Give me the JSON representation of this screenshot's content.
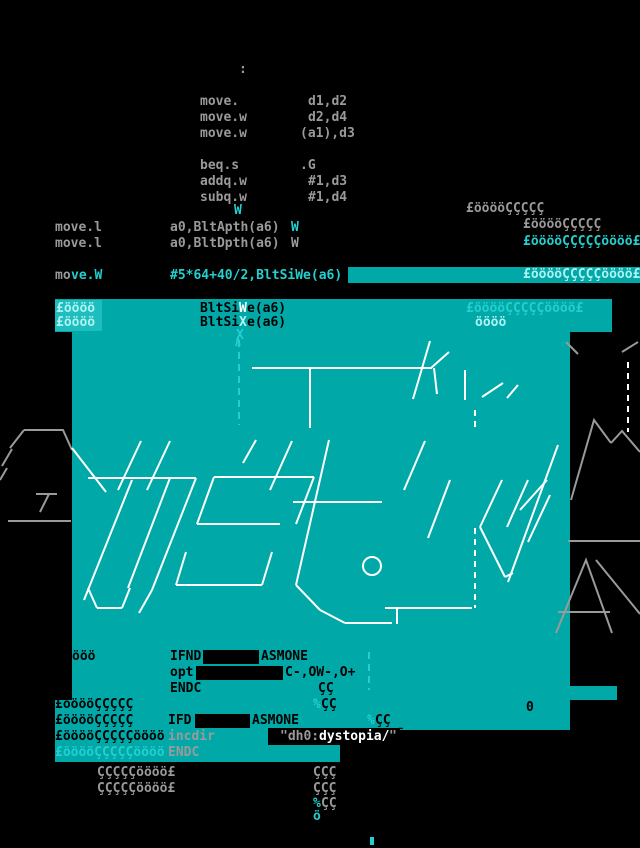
{
  "palette": {
    "black": "#000000",
    "teal": "#00A8A8",
    "pale_box": "#1FBEBE",
    "cyan": "#24CFCF",
    "bright": "#AFF2F2",
    "gray": "#9A9A9A",
    "white": "#FFFFFF"
  },
  "screen": {
    "width": 640,
    "height": 848,
    "background": "#000000"
  },
  "boxes": [
    {
      "n": "move-w-highlight-bar",
      "x": 348,
      "y": 267,
      "w": 292,
      "h": 16,
      "c": "teal"
    },
    {
      "n": "bltsize-band",
      "x": 55,
      "y": 299,
      "w": 557,
      "h": 33,
      "c": "teal"
    },
    {
      "n": "pale-highlight-box",
      "x": 55,
      "y": 300,
      "w": 47,
      "h": 31,
      "c": "pale_box"
    },
    {
      "n": "main-teal-block",
      "x": 72,
      "y": 332,
      "w": 498,
      "h": 323,
      "c": "teal"
    },
    {
      "n": "lower-teal-band",
      "x": 55,
      "y": 655,
      "w": 515,
      "h": 75,
      "c": "teal"
    },
    {
      "n": "teal-notch-right",
      "x": 570,
      "y": 686,
      "w": 47,
      "h": 14,
      "c": "teal"
    },
    {
      "n": "bottom-teal-strip",
      "x": 55,
      "y": 730,
      "w": 285,
      "h": 32,
      "c": "teal"
    },
    {
      "n": "left-black-box",
      "x": 55,
      "y": 648,
      "w": 17,
      "h": 52,
      "c": "black"
    },
    {
      "n": "ifnd-redacted-box",
      "x": 203,
      "y": 650,
      "w": 56,
      "h": 14,
      "c": "black"
    },
    {
      "n": "opt-redacted-box",
      "x": 196,
      "y": 666,
      "w": 87,
      "h": 14,
      "c": "black"
    },
    {
      "n": "ifd-redacted-box",
      "x": 195,
      "y": 714,
      "w": 55,
      "h": 14,
      "c": "black"
    },
    {
      "n": "dystopia-black-box",
      "x": 268,
      "y": 728,
      "w": 132,
      "h": 17,
      "c": "black"
    },
    {
      "n": "bottom-cyan-tick",
      "x": 370,
      "y": 837,
      "w": 4,
      "h": 8,
      "c": "cyan"
    }
  ],
  "texts": [
    {
      "n": "label-colon",
      "x": 239,
      "y": 63,
      "c": "gray",
      "t": ":"
    },
    {
      "n": "asm-op",
      "x": 200,
      "y": 95,
      "c": "gray",
      "t": "move."
    },
    {
      "n": "asm-arg",
      "x": 308,
      "y": 95,
      "c": "gray",
      "t": "d1,d2"
    },
    {
      "n": "asm-op",
      "x": 200,
      "y": 111,
      "c": "gray",
      "t": "move.w"
    },
    {
      "n": "asm-arg",
      "x": 308,
      "y": 111,
      "c": "gray",
      "t": "d2,d4"
    },
    {
      "n": "asm-op",
      "x": 200,
      "y": 127,
      "c": "gray",
      "t": "move.w"
    },
    {
      "n": "asm-arg",
      "x": 300,
      "y": 127,
      "c": "gray",
      "t": "(a1),d3"
    },
    {
      "n": "asm-op",
      "x": 200,
      "y": 159,
      "c": "gray",
      "t": "beq.s"
    },
    {
      "n": "asm-arg",
      "x": 300,
      "y": 159,
      "c": "gray",
      "t": ".G"
    },
    {
      "n": "asm-op",
      "x": 200,
      "y": 175,
      "c": "gray",
      "t": "addq.w"
    },
    {
      "n": "asm-arg",
      "x": 308,
      "y": 175,
      "c": "gray",
      "t": "#1,d3"
    },
    {
      "n": "asm-op",
      "x": 200,
      "y": 191,
      "c": "gray",
      "t": "subq.w"
    },
    {
      "n": "asm-arg",
      "x": 308,
      "y": 191,
      "c": "gray",
      "t": "#1,d4"
    },
    {
      "n": "stray-w",
      "x": 234,
      "y": 204,
      "c": "cyan",
      "t": "W"
    },
    {
      "n": "asm-op",
      "x": 55,
      "y": 221,
      "c": "gray",
      "t": "move.l"
    },
    {
      "n": "asm-arg",
      "x": 170,
      "y": 221,
      "c": "gray",
      "t": "a0,BltApth(a6)"
    },
    {
      "n": "stray-w",
      "x": 291,
      "y": 221,
      "c": "cyan",
      "t": "W"
    },
    {
      "n": "asm-op",
      "x": 55,
      "y": 237,
      "c": "gray",
      "t": "move.l"
    },
    {
      "n": "asm-arg",
      "x": 170,
      "y": 237,
      "c": "gray",
      "t": "a0,BltDpth(a6)"
    },
    {
      "n": "stray-w",
      "x": 291,
      "y": 237,
      "c": "gray",
      "t": "W"
    },
    {
      "n": "asm-op",
      "x": 55,
      "y": 269,
      "c": "gray",
      "t": "mo"
    },
    {
      "n": "asm-op",
      "x": 71,
      "y": 269,
      "c": "cyan",
      "t": "ve.W"
    },
    {
      "n": "asm-arg",
      "x": 170,
      "y": 269,
      "c": "cyan",
      "t": "#5*64+40/2,BltSiWe(a6)"
    },
    {
      "n": "glyph-row",
      "x": 466,
      "y": 202,
      "c": "gray",
      "t": "£ööööÇÇÇÇÇ"
    },
    {
      "n": "glyph-row",
      "x": 523,
      "y": 218,
      "c": "gray",
      "t": "£ööööÇÇÇÇÇ"
    },
    {
      "n": "glyph-row",
      "x": 523,
      "y": 235,
      "c": "cyan",
      "t": "£ööööÇÇÇÇÇöööö£"
    },
    {
      "n": "glyph-row",
      "x": 523,
      "y": 268,
      "c": "bright",
      "t": "£ööööÇÇÇÇÇöööö£"
    },
    {
      "n": "glyph-row",
      "x": 466,
      "y": 302,
      "c": "cyan",
      "t": "£ööööÇÇÇÇÇöööö£"
    },
    {
      "n": "glyph-row",
      "x": 475,
      "y": 316,
      "c": "bright",
      "t": "öööö"
    },
    {
      "n": "glyph-row",
      "x": 56,
      "y": 302,
      "c": "bright",
      "t": "£öööö"
    },
    {
      "n": "asm-arg",
      "x": 200,
      "y": 302,
      "c": "black",
      "t": "BltSi"
    },
    {
      "n": "stray-w",
      "x": 239,
      "y": 302,
      "c": "white",
      "t": "W"
    },
    {
      "n": "asm-arg",
      "x": 247,
      "y": 302,
      "c": "black",
      "t": "e(a6)"
    },
    {
      "n": "glyph-row",
      "x": 56,
      "y": 316,
      "c": "bright",
      "t": "£öööö"
    },
    {
      "n": "asm-arg",
      "x": 200,
      "y": 316,
      "c": "black",
      "t": "BltSi"
    },
    {
      "n": "stray-x",
      "x": 239,
      "y": 316,
      "c": "bright",
      "t": "X"
    },
    {
      "n": "asm-arg",
      "x": 247,
      "y": 316,
      "c": "black",
      "t": "e(a6)"
    },
    {
      "n": "stray-x",
      "x": 236,
      "y": 329,
      "c": "cyan",
      "t": "X"
    },
    {
      "n": "arrow-up",
      "x": 234,
      "y": 336,
      "c": "cyan",
      "t": "∧"
    },
    {
      "n": "glyph-row",
      "x": 72,
      "y": 650,
      "c": "black",
      "t": "ööö"
    },
    {
      "n": "asm-directive",
      "x": 170,
      "y": 650,
      "c": "black",
      "t": "IFND"
    },
    {
      "n": "asm-directive",
      "x": 261,
      "y": 650,
      "c": "black",
      "t": "ASMONE"
    },
    {
      "n": "asm-directive",
      "x": 170,
      "y": 666,
      "c": "black",
      "t": "opt"
    },
    {
      "n": "asm-arg",
      "x": 285,
      "y": 666,
      "c": "black",
      "t": "C-,OW-,O+"
    },
    {
      "n": "asm-directive",
      "x": 170,
      "y": 682,
      "c": "black",
      "t": "ENDC"
    },
    {
      "n": "glyph-row",
      "x": 318,
      "y": 682,
      "c": "black",
      "t": "ÇÇ"
    },
    {
      "n": "glyph-pct",
      "x": 313,
      "y": 698,
      "c": "cyan",
      "t": "%"
    },
    {
      "n": "glyph-row",
      "x": 321,
      "y": 698,
      "c": "black",
      "t": "ÇÇ"
    },
    {
      "n": "glyph-zero",
      "x": 526,
      "y": 701,
      "c": "black",
      "t": "0"
    },
    {
      "n": "glyph-row",
      "x": 55,
      "y": 698,
      "c": "black",
      "t": "£ööööÇÇÇÇÇ"
    },
    {
      "n": "glyph-row",
      "x": 55,
      "y": 714,
      "c": "black",
      "t": "£ööööÇÇÇÇÇ"
    },
    {
      "n": "asm-directive",
      "x": 168,
      "y": 714,
      "c": "black",
      "t": "IFD"
    },
    {
      "n": "asm-directive",
      "x": 252,
      "y": 714,
      "c": "black",
      "t": "ASMONE"
    },
    {
      "n": "glyph-pct",
      "x": 367,
      "y": 714,
      "c": "cyan",
      "t": "%"
    },
    {
      "n": "glyph-row",
      "x": 375,
      "y": 714,
      "c": "black",
      "t": "ÇÇ"
    },
    {
      "n": "glyph-row",
      "x": 55,
      "y": 730,
      "c": "black",
      "t": "£ööööÇÇÇÇÇöööö"
    },
    {
      "n": "asm-directive",
      "x": 168,
      "y": 730,
      "c": "gray",
      "t": "incdir"
    },
    {
      "n": "asm-arg",
      "x": 280,
      "y": 730,
      "c": "gray",
      "t": "\"dh0:"
    },
    {
      "n": "asm-arg",
      "x": 319,
      "y": 730,
      "c": "white",
      "t": "dystopia/"
    },
    {
      "n": "asm-arg",
      "x": 389,
      "y": 730,
      "c": "gray",
      "t": "\""
    },
    {
      "n": "glyph-macron",
      "x": 397,
      "y": 728,
      "c": "black",
      "t": "¯"
    },
    {
      "n": "glyph-row",
      "x": 55,
      "y": 746,
      "c": "cyan",
      "t": "£ööööÇÇÇÇÇöööö"
    },
    {
      "n": "asm-directive",
      "x": 168,
      "y": 746,
      "c": "gray",
      "t": "ENDC"
    },
    {
      "n": "glyph-row",
      "x": 97,
      "y": 766,
      "c": "gray",
      "t": "ÇÇÇÇÇöööö£"
    },
    {
      "n": "glyph-row",
      "x": 97,
      "y": 782,
      "c": "gray",
      "t": "ÇÇÇÇÇöööö£"
    },
    {
      "n": "glyph-row",
      "x": 313,
      "y": 766,
      "c": "gray",
      "t": "ÇÇÇ"
    },
    {
      "n": "glyph-row",
      "x": 313,
      "y": 782,
      "c": "gray",
      "t": "ÇÇÇ"
    },
    {
      "n": "glyph-pct",
      "x": 313,
      "y": 797,
      "c": "cyan",
      "t": "%"
    },
    {
      "n": "glyph-row",
      "x": 321,
      "y": 797,
      "c": "gray",
      "t": "ÇÇ"
    },
    {
      "n": "glyph-row",
      "x": 313,
      "y": 810,
      "c": "cyan",
      "t": "ö"
    }
  ],
  "art": {
    "white_lines": [
      "252,368 432,368",
      "430,341 413,399",
      "449,352 431,368",
      "434,368 437,394",
      "465,370 465,400",
      "482,397 503,383",
      "507,398 518,385",
      "310,368 310,428",
      "72,448 106,492",
      "88,478 196,478",
      "196,478 152,590",
      "170,478 128,588",
      "152,590 139,613",
      "88,588 97,608",
      "97,608 122,608",
      "130,588 122,608",
      "132,480 84,600",
      "214,477 314,477",
      "314,477 296,524",
      "214,477 197,524",
      "197,524 280,524",
      "186,552 176,585",
      "176,585 262,585",
      "262,585 272,552",
      "329,440 296,585",
      "293,502 382,502",
      "296,585 320,610",
      "320,610 345,623",
      "345,623 392,623",
      "385,608 472,608",
      "397,608 397,624",
      "502,480 480,527",
      "480,527 505,577",
      "505,577 513,573",
      "528,480 507,527",
      "547,480 520,510",
      "550,495 528,542",
      "558,445 508,582",
      "118,490 141,441",
      "147,490 170,441",
      "243,463 256,440",
      "270,490 292,441",
      "404,490 425,441",
      "450,480 428,538"
    ],
    "white_dashed": [
      "475,528 475,608",
      "475,410 475,432",
      "628,362 628,432"
    ],
    "gray_lines": [
      "24,430 63,430 72,450",
      "24,430 10,448",
      "2,466 12,449",
      "0,480 7,468",
      "8,521 71,521",
      "36,494 57,494",
      "49,494 40,512",
      "571,500 594,420 611,443",
      "611,443 622,431 640,452",
      "568,541 640,541",
      "556,633 586,560 612,633",
      "558,612 610,612",
      "596,560 640,614",
      "566,342 578,354",
      "638,342 622,352"
    ],
    "cyan_dashed": [
      "239,340 239,425",
      "369,652 369,690"
    ],
    "circle": {
      "cx": 372,
      "cy": 566,
      "r": 9
    }
  }
}
